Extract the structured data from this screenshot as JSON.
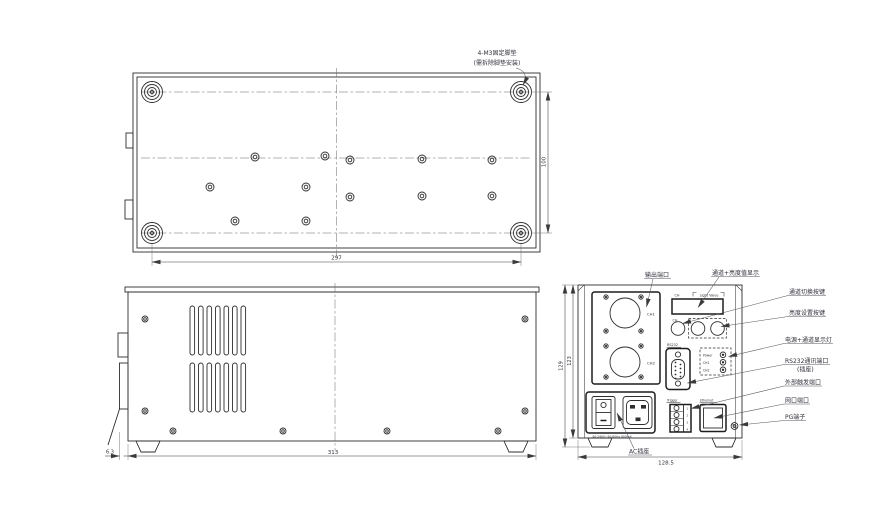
{
  "top_view": {
    "note1": "4-M3固定脚垫",
    "note2": "(需拆除脚垫安装)",
    "dim_width": "297",
    "dim_depth": "100"
  },
  "side_view": {
    "dim_width": "313",
    "dim_offset": "6.3"
  },
  "rear_view": {
    "dim_width": "128.5",
    "dim_height_outer": "129",
    "dim_height_inner": "123",
    "panel": {
      "ch1": "CH1",
      "ch2": "CH2",
      "display_ch": "CH",
      "display_label": "Light Value",
      "btn_ch": "CH",
      "rs232": "RS232",
      "led_power": "Power",
      "led_ch1": "CH1",
      "led_ch2": "CH2",
      "trigger": "Trigger",
      "ethernet": "Ethernet",
      "pin1": "1",
      "pin2": "2",
      "pin3": "3",
      "pin4": "4",
      "ac_rating": "90-240V~50/60Hz 800mA"
    },
    "callouts": {
      "output": "输出端口",
      "display": "通道+亮度值显示",
      "channel_switch": "通道切换按键",
      "brightness": "亮度设置按键",
      "leds": "电源+通道显示灯",
      "rs232_1": "RS232通讯端口",
      "rs232_2": "(插座)",
      "trigger": "外部触发端口",
      "ethernet": "网口端口",
      "pg": "PG端子",
      "ac": "AC插座"
    }
  }
}
